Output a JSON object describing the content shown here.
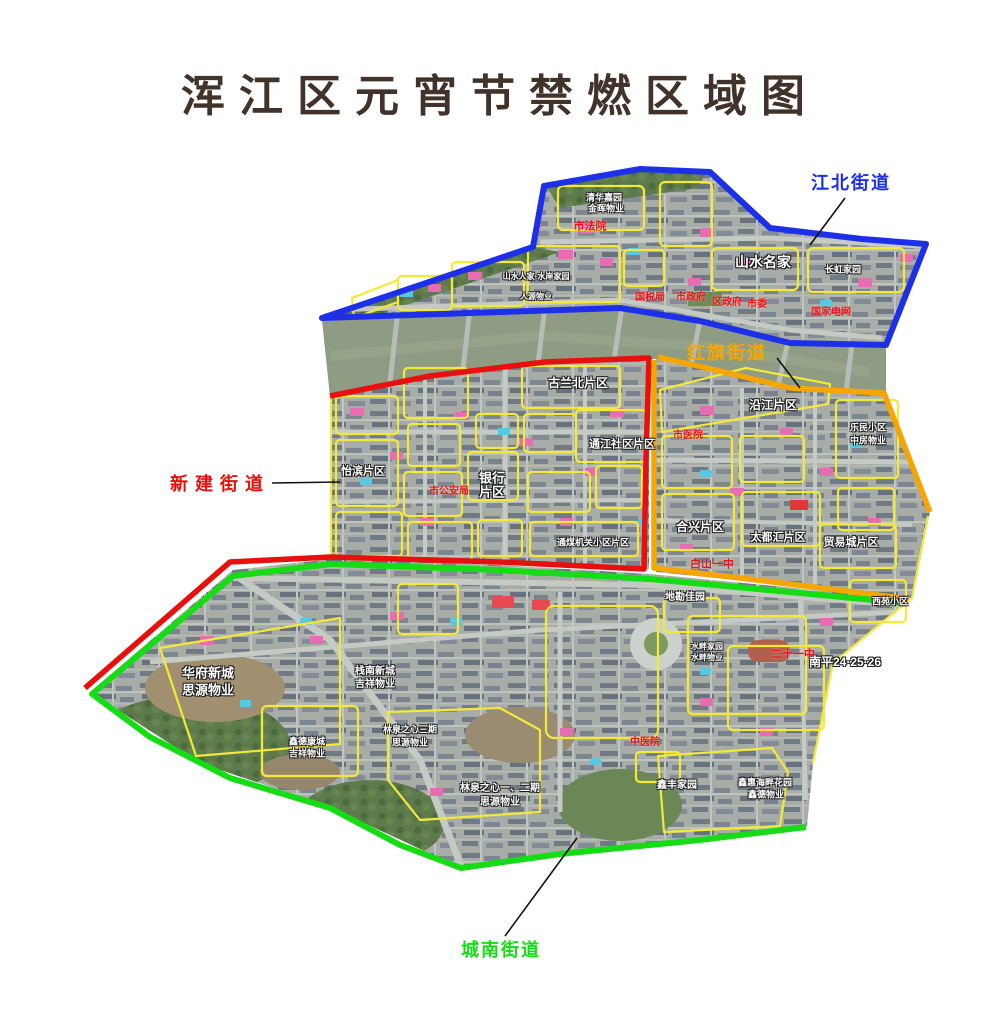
{
  "title": "浑江区元宵节禁燃区域图",
  "title_color": "#42332a",
  "districts": [
    {
      "id": "jiangbei",
      "name": "江北街道",
      "color": "#1d2fe8",
      "label": {
        "x": 851,
        "y": 182
      },
      "leader": {
        "x1": 845,
        "y1": 198,
        "x2": 810,
        "y2": 245
      }
    },
    {
      "id": "hongqi",
      "name": "红旗街道",
      "color": "#f7a600",
      "label": {
        "x": 727,
        "y": 352
      },
      "leader": {
        "x1": 777,
        "y1": 358,
        "x2": 800,
        "y2": 388
      }
    },
    {
      "id": "xinjian",
      "name": "新建街道",
      "color": "#e8100c",
      "label": {
        "x": 220,
        "y": 483
      },
      "leader": {
        "x1": 272,
        "y1": 483,
        "x2": 340,
        "y2": 482
      }
    },
    {
      "id": "chengnan",
      "name": "城南街道",
      "color": "#16dc16",
      "label": {
        "x": 501,
        "y": 949
      },
      "leader": {
        "x1": 505,
        "y1": 936,
        "x2": 577,
        "y2": 838
      }
    }
  ],
  "map": {
    "river_color": "#8e9c83",
    "sub_region_outline_color": "#f2e93a",
    "leader_line_color": "#111111",
    "labels": [
      {
        "text": "山水名家",
        "x": 763,
        "y": 262,
        "color": "white",
        "size": 14
      },
      {
        "text": "长虹家园",
        "x": 843,
        "y": 270,
        "color": "white",
        "size": 9
      },
      {
        "text": "清华嘉园",
        "x": 604,
        "y": 198,
        "color": "white",
        "size": 9
      },
      {
        "text": "金晖物业",
        "x": 606,
        "y": 209,
        "color": "white",
        "size": 9
      },
      {
        "text": "山水人家·水岸家园",
        "x": 536,
        "y": 277,
        "color": "white",
        "size": 8
      },
      {
        "text": "人源物业",
        "x": 536,
        "y": 297,
        "color": "white",
        "size": 8
      },
      {
        "text": "怡滨片区",
        "x": 363,
        "y": 472,
        "color": "white",
        "size": 11
      },
      {
        "text": "银行",
        "x": 492,
        "y": 478,
        "color": "white",
        "size": 13
      },
      {
        "text": "片区",
        "x": 492,
        "y": 492,
        "color": "white",
        "size": 13
      },
      {
        "text": "古兰北片区",
        "x": 578,
        "y": 383,
        "color": "white",
        "size": 12
      },
      {
        "text": "通江社区片区",
        "x": 622,
        "y": 445,
        "color": "white",
        "size": 11
      },
      {
        "text": "沿江片区",
        "x": 773,
        "y": 405,
        "color": "white",
        "size": 12
      },
      {
        "text": "乐民小区",
        "x": 868,
        "y": 428,
        "color": "white",
        "size": 9
      },
      {
        "text": "中房物业",
        "x": 868,
        "y": 441,
        "color": "white",
        "size": 9
      },
      {
        "text": "合兴片区",
        "x": 700,
        "y": 527,
        "color": "white",
        "size": 12
      },
      {
        "text": "太都汇片区",
        "x": 778,
        "y": 538,
        "color": "white",
        "size": 11
      },
      {
        "text": "贸易城片区",
        "x": 851,
        "y": 543,
        "color": "white",
        "size": 11
      },
      {
        "text": "通煤机关小区片区",
        "x": 593,
        "y": 543,
        "color": "white",
        "size": 9
      },
      {
        "text": "地勘佳园",
        "x": 685,
        "y": 598,
        "color": "white",
        "size": 10
      },
      {
        "text": "西苑小区",
        "x": 890,
        "y": 602,
        "color": "white",
        "size": 9
      },
      {
        "text": "南平24·25·26",
        "x": 845,
        "y": 662,
        "color": "white",
        "size": 12
      },
      {
        "text": "华府新城",
        "x": 208,
        "y": 673,
        "color": "white",
        "size": 13
      },
      {
        "text": "思源物业",
        "x": 208,
        "y": 690,
        "color": "white",
        "size": 13
      },
      {
        "text": "栈南新城",
        "x": 375,
        "y": 672,
        "color": "white",
        "size": 10
      },
      {
        "text": "吉祥物业",
        "x": 375,
        "y": 685,
        "color": "white",
        "size": 10
      },
      {
        "text": "鑫德康城",
        "x": 307,
        "y": 742,
        "color": "white",
        "size": 9
      },
      {
        "text": "吉祥物业",
        "x": 307,
        "y": 754,
        "color": "white",
        "size": 9
      },
      {
        "text": "林泉之心三期",
        "x": 410,
        "y": 730,
        "color": "white",
        "size": 9
      },
      {
        "text": "思源物业",
        "x": 410,
        "y": 743,
        "color": "white",
        "size": 9
      },
      {
        "text": "林泉之心一、二期",
        "x": 500,
        "y": 789,
        "color": "white",
        "size": 10
      },
      {
        "text": "思源物业",
        "x": 500,
        "y": 803,
        "color": "white",
        "size": 10
      },
      {
        "text": "水畔家园",
        "x": 707,
        "y": 647,
        "color": "white",
        "size": 8
      },
      {
        "text": "水畔物业",
        "x": 707,
        "y": 658,
        "color": "white",
        "size": 8
      },
      {
        "text": "鑫丰家园",
        "x": 677,
        "y": 786,
        "color": "white",
        "size": 10
      },
      {
        "text": "鑫惠海畔花园",
        "x": 765,
        "y": 783,
        "color": "white",
        "size": 9
      },
      {
        "text": "鑫德物业",
        "x": 766,
        "y": 795,
        "color": "white",
        "size": 9
      },
      {
        "text": "市法院",
        "x": 590,
        "y": 227,
        "color": "red",
        "size": 11
      },
      {
        "text": "国税局",
        "x": 650,
        "y": 298,
        "color": "red",
        "size": 10
      },
      {
        "text": "市政府",
        "x": 691,
        "y": 298,
        "color": "red",
        "size": 10
      },
      {
        "text": "区政府",
        "x": 727,
        "y": 303,
        "color": "red",
        "size": 10
      },
      {
        "text": "市委",
        "x": 757,
        "y": 305,
        "color": "red",
        "size": 10
      },
      {
        "text": "国家电网",
        "x": 831,
        "y": 313,
        "color": "red",
        "size": 10
      },
      {
        "text": "市公安局",
        "x": 449,
        "y": 492,
        "color": "red",
        "size": 10
      },
      {
        "text": "市医院",
        "x": 688,
        "y": 436,
        "color": "red",
        "size": 10
      },
      {
        "text": "白山一中",
        "x": 712,
        "y": 565,
        "color": "red",
        "size": 11
      },
      {
        "text": "二十一中",
        "x": 793,
        "y": 655,
        "color": "red",
        "size": 11
      },
      {
        "text": "中医院",
        "x": 645,
        "y": 743,
        "color": "red",
        "size": 10
      }
    ]
  }
}
